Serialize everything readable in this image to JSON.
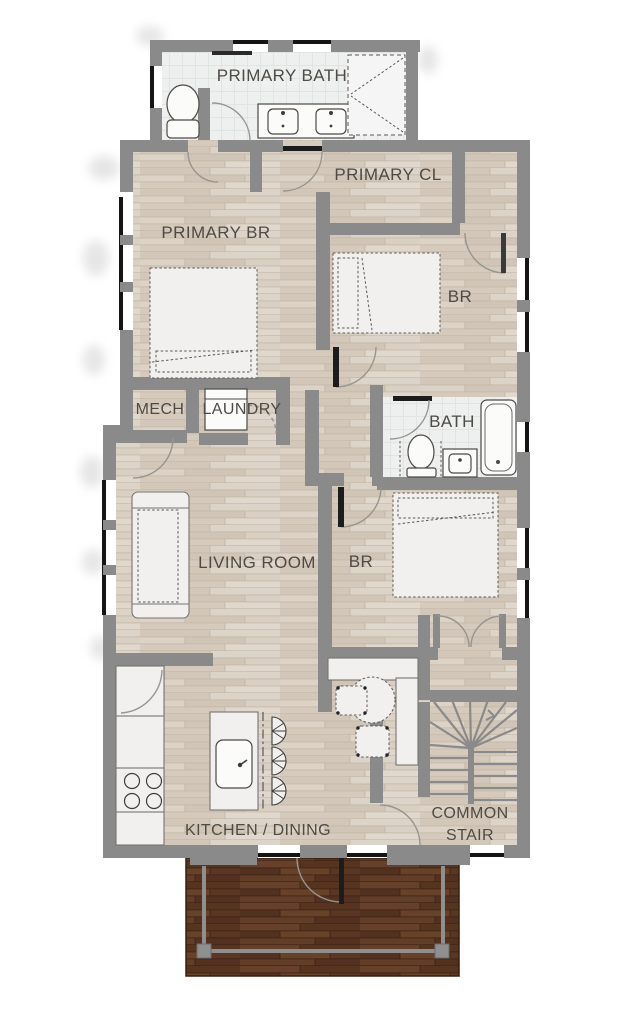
{
  "plan": {
    "title": "apartment-unit-floor-plan",
    "rooms": {
      "primary_bath": "PRIMARY BATH",
      "primary_cl": "PRIMARY CL",
      "primary_br": "PRIMARY BR",
      "br_upper": "BR",
      "mech": "MECH",
      "laundry": "LAUNDRY",
      "bath": "BATH",
      "living_room": "LIVING ROOM",
      "br_lower": "BR",
      "kitchen_dining": "KITCHEN / DINING",
      "common_stair_line1": "COMMON",
      "common_stair_line2": "STAIR"
    },
    "colors": {
      "wall": "#8a8a8a",
      "floor_wood": "#d8cec2",
      "tile": "#eef0ef",
      "deck_wood": "#5e3a27",
      "railing": "#8f8f8f",
      "label_text": "#4e4a45",
      "window_glazing": "#151515",
      "furniture_fill": "#f1f0ee",
      "background": "#ffffff"
    }
  }
}
